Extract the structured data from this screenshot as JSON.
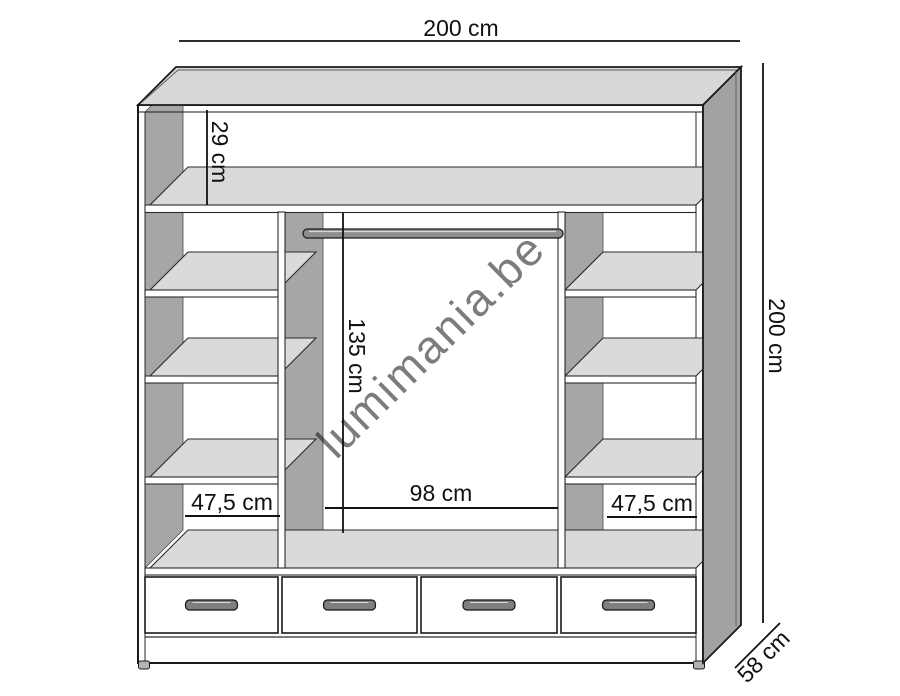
{
  "drawing": {
    "watermark": "lumimania.be",
    "labels": {
      "overall_width": "200 cm",
      "overall_height": "200 cm",
      "depth": "58 cm",
      "top_compartment_height": "29 cm",
      "hanging_space_height": "135 cm",
      "hanging_space_width": "98 cm",
      "left_compartment_width": "47,5 cm",
      "right_compartment_width": "47,5 cm"
    },
    "structure": {
      "drawer_count": 4,
      "left_shelf_openings": 4,
      "right_shelf_openings": 4,
      "has_hanging_rod": true
    },
    "colors": {
      "outline": "#1a1a1a",
      "top_face": "#d8d8d8",
      "side_face": "#a2a2a2",
      "inner_panel": "#a6a6a6",
      "shelf_top": "#dadada",
      "rod": "#8e8e8e",
      "handle": "#7e7e7e",
      "watermark": "#bdbdbd"
    }
  }
}
